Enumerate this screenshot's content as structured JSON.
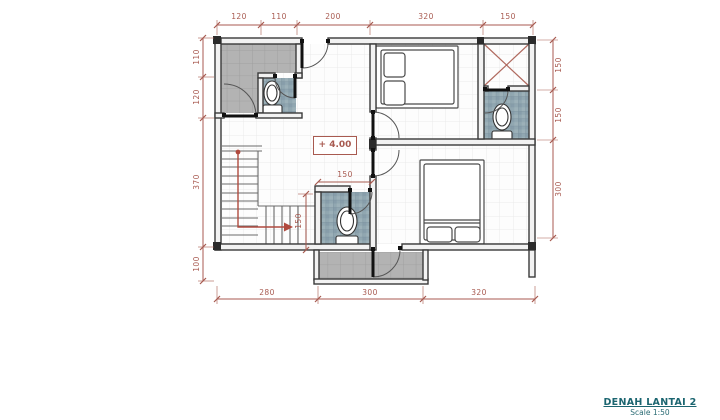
{
  "document": {
    "title": "DENAH LANTAI 2",
    "scale": "Scale 1:50",
    "level_marker": "+ 4.00"
  },
  "dimensions": {
    "top": [
      "120",
      "110",
      "200",
      "320",
      "150"
    ],
    "left": [
      "110",
      "120",
      "370",
      "100"
    ],
    "right": [
      "150",
      "150",
      "300"
    ],
    "bottom": [
      "280",
      "300",
      "320"
    ],
    "interior": {
      "bath_width": "150",
      "stair_run": "150"
    }
  },
  "colors": {
    "dimension_red": "#a85a50",
    "wall_dark": "#3a3a3a",
    "tile_blue": "#91a7b1",
    "tile_gray": "#b3b3b3",
    "balcony_gray": "#b3b3b3",
    "title_teal": "#1b6570",
    "stair_arrow_red": "#b04a3e"
  }
}
